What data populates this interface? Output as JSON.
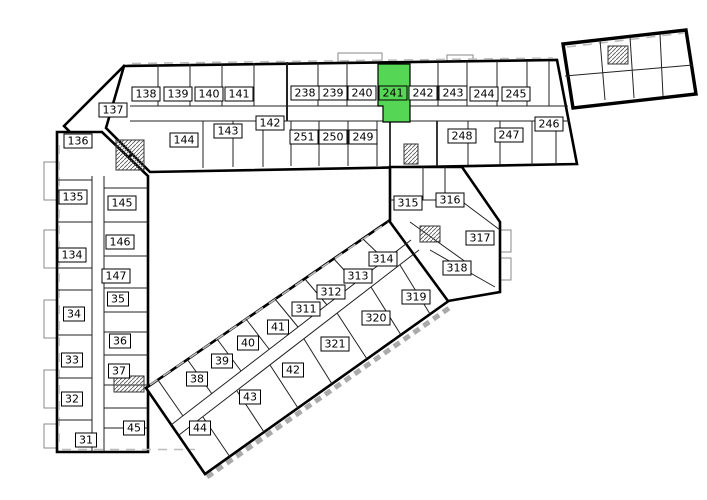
{
  "plan": {
    "name": "building-floor-plan",
    "background_color": "#ffffff",
    "wall_color": "#000000"
  },
  "highlight": {
    "room": "241",
    "color": "#55d655"
  },
  "rooms": {
    "r31": "31",
    "r32": "32",
    "r33": "33",
    "r34": "34",
    "r35": "35",
    "r36": "36",
    "r37": "37",
    "r38": "38",
    "r39": "39",
    "r40": "40",
    "r41": "41",
    "r42": "42",
    "r43": "43",
    "r44": "44",
    "r45": "45",
    "r134": "134",
    "r135": "135",
    "r136": "136",
    "r137": "137",
    "r138": "138",
    "r139": "139",
    "r140": "140",
    "r141": "141",
    "r142": "142",
    "r143": "143",
    "r144": "144",
    "r145": "145",
    "r146": "146",
    "r147": "147",
    "r238": "238",
    "r239": "239",
    "r240": "240",
    "r241": "241",
    "r242": "242",
    "r243": "243",
    "r244": "244",
    "r245": "245",
    "r246": "246",
    "r247": "247",
    "r248": "248",
    "r249": "249",
    "r250": "250",
    "r251": "251",
    "r311": "311",
    "r312": "312",
    "r313": "313",
    "r314": "314",
    "r315": "315",
    "r316": "316",
    "r317": "317",
    "r318": "318",
    "r319": "319",
    "r320": "320",
    "r321": "321"
  }
}
